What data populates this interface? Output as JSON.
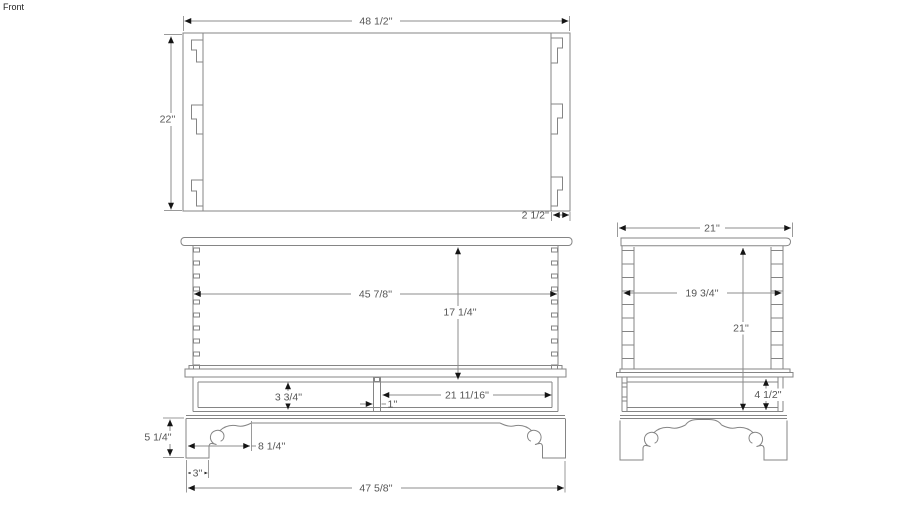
{
  "scene_label": "Front",
  "colors": {
    "background": "#ffffff",
    "geometry_line": "#858585",
    "dimension_line": "#8c8c8c",
    "arrow": "#151515",
    "dimension_text": "#555555",
    "label_text": "#222222"
  },
  "views": {
    "top": {
      "name": "Top view (plan of chest)",
      "dimensions": {
        "overall_width": "48 1/2''",
        "overall_depth": "22''",
        "side_thickness": "2 1/2''"
      }
    },
    "front": {
      "name": "Front elevation",
      "dimensions": {
        "interior_width": "45 7/8''",
        "case_height": "17 1/4''",
        "rail_height": "3 3/4''",
        "drawer_opening_width": "21 11/16''",
        "divider_width": "1''",
        "base_height": "5 1/4''",
        "bracket_foot_width": "8 1/4''",
        "foot_width": "3''",
        "overall_width": "47 5/8''"
      }
    },
    "side": {
      "name": "Side elevation",
      "dimensions": {
        "overall_depth": "21''",
        "interior_depth": "19 3/4''",
        "overall_height": "21''",
        "skirt_height": "4 1/2''"
      }
    }
  }
}
